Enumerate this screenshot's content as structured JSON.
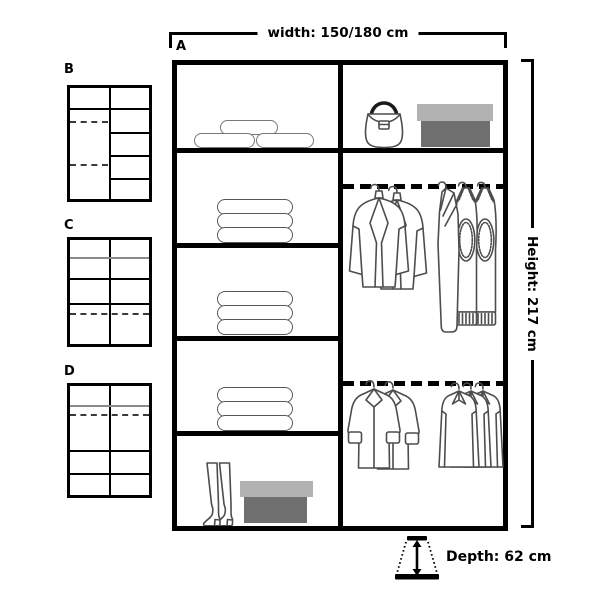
{
  "diagram": {
    "main_label": "A",
    "width_label": "width: 150/180 cm",
    "height_label": "Height: 217 cm",
    "depth_label": "Depth: 62 cm",
    "variants": [
      {
        "label": "B"
      },
      {
        "label": "C"
      },
      {
        "label": "D"
      }
    ],
    "contents": {
      "left_shelves": [
        "rolled-textiles",
        "folded-clothes-stack",
        "folded-clothes-stack",
        "folded-clothes-stack",
        "boots-with-shoebox"
      ],
      "top_right_shelf": [
        "handbag",
        "storage-box"
      ],
      "upper_rail": [
        "jackets-on-hangers",
        "sweaters-on-hangers"
      ],
      "lower_rail": [
        "coats-on-hangers",
        "shirts-on-hangers"
      ]
    },
    "colors": {
      "structure": "#000000",
      "illustration_stroke": "#4d4d4d",
      "box_lid": "#b2b2b2",
      "box_body": "#6f6f6f"
    }
  }
}
